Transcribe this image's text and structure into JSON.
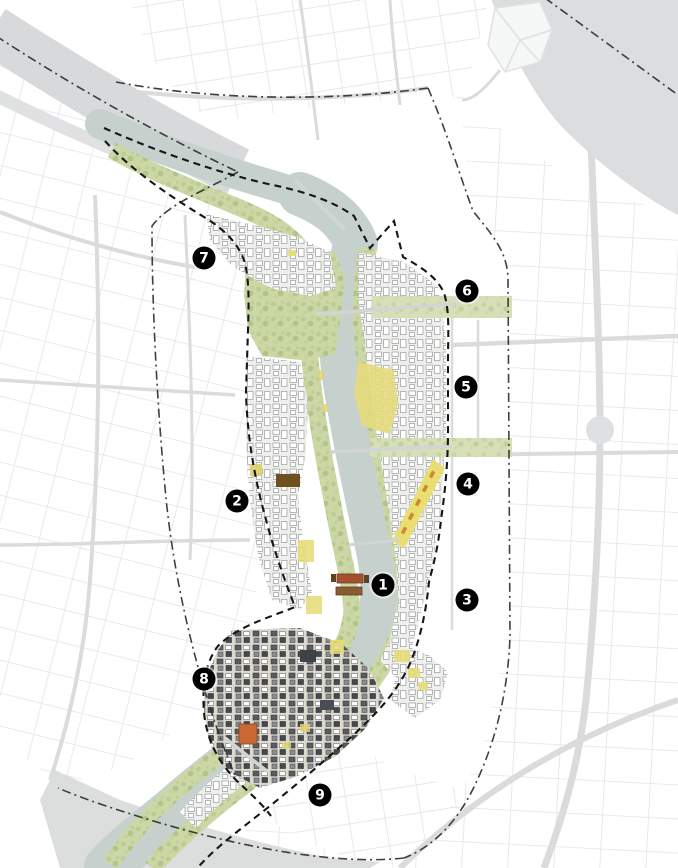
{
  "map": {
    "markers": [
      {
        "label": "1",
        "x": 383,
        "y": 585
      },
      {
        "label": "2",
        "x": 237,
        "y": 501
      },
      {
        "label": "3",
        "x": 467,
        "y": 600
      },
      {
        "label": "4",
        "x": 468,
        "y": 484
      },
      {
        "label": "5",
        "x": 466,
        "y": 387
      },
      {
        "label": "6",
        "x": 467,
        "y": 291
      },
      {
        "label": "7",
        "x": 204,
        "y": 258
      },
      {
        "label": "8",
        "x": 204,
        "y": 679
      },
      {
        "label": "9",
        "x": 320,
        "y": 795
      }
    ],
    "colors": {
      "background": "#ffffff",
      "context_road": "#e2e3e6",
      "context_water": "#dcddde",
      "river": "#c6d1cd",
      "greenway": "#ccd7a6",
      "fabric_base": "#eef0e9",
      "fabric_outline": "#979ca3",
      "dense_fabric": "#585c61",
      "highlight_yellow": "#e6db74",
      "highlight_orange": "#d08a2c",
      "highlight_red": "#a8502e",
      "boundary": "#1a1a1a",
      "marker_background": "#000000",
      "marker_text": "#ffffff"
    }
  }
}
